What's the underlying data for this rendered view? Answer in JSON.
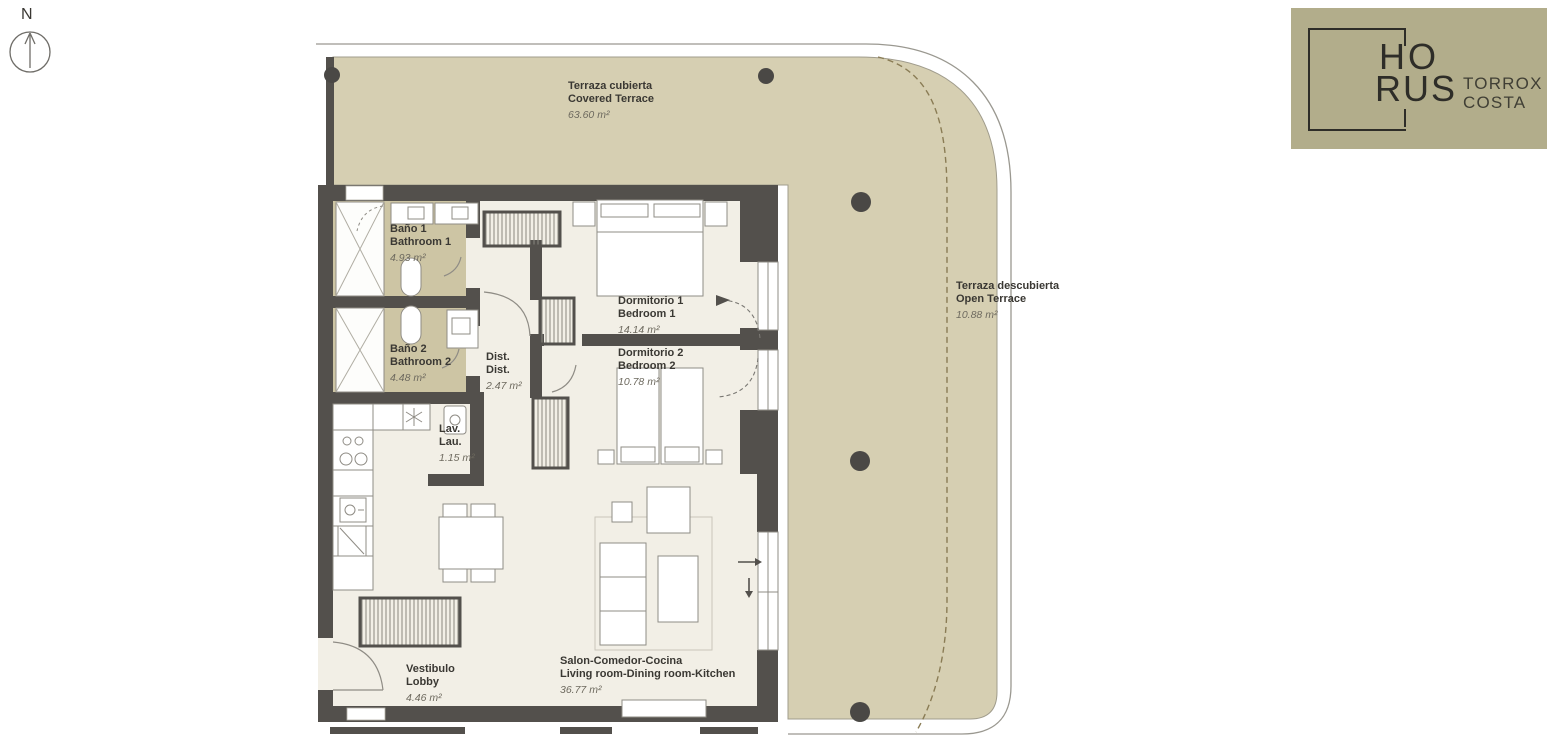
{
  "compass": {
    "label": "N"
  },
  "logo": {
    "word_top": "HO",
    "word_bottom": "RUS",
    "brand_line1": "TORROX",
    "brand_line2": "COSTA",
    "bg_color": "#b2ad8b",
    "ink_color": "#2e2d28"
  },
  "plan": {
    "colors": {
      "terrace_floor": "#d6cfb2",
      "bathroom_floor": "#cdc5a4",
      "interior_floor": "#f2efe6",
      "walls": "#53504c",
      "furniture_stroke": "#8f8c85",
      "terrace_divider_dash": "#8a7c55"
    },
    "rooms": [
      {
        "id": "covered-terrace",
        "name_es": "Terraza cubierta",
        "name_en": "Covered Terrace",
        "area": "63.60 m²"
      },
      {
        "id": "bathroom-1",
        "name_es": "Baño 1",
        "name_en": "Bathroom 1",
        "area": "4.93 m²"
      },
      {
        "id": "bathroom-2",
        "name_es": "Baño 2",
        "name_en": "Bathroom 2",
        "area": "4.48 m²"
      },
      {
        "id": "distributor",
        "name_es": "Dist.",
        "name_en": "Dist.",
        "area": "2.47 m²"
      },
      {
        "id": "bedroom-1",
        "name_es": "Dormitorio 1",
        "name_en": "Bedroom 1",
        "area": "14.14 m²"
      },
      {
        "id": "bedroom-2",
        "name_es": "Dormitorio 2",
        "name_en": "Bedroom 2",
        "area": "10.78 m²"
      },
      {
        "id": "laundry",
        "name_es": "Lav.",
        "name_en": "Lau.",
        "area": "1.15 m²"
      },
      {
        "id": "open-terrace",
        "name_es": "Terraza descubierta",
        "name_en": "Open Terrace",
        "area": "10.88 m²"
      },
      {
        "id": "lobby",
        "name_es": "Vestibulo",
        "name_en": "Lobby",
        "area": "4.46 m²"
      },
      {
        "id": "living",
        "name_es": "Salon-Comedor-Cocina",
        "name_en": "Living room-Dining room-Kitchen",
        "area": "36.77 m²"
      }
    ]
  }
}
